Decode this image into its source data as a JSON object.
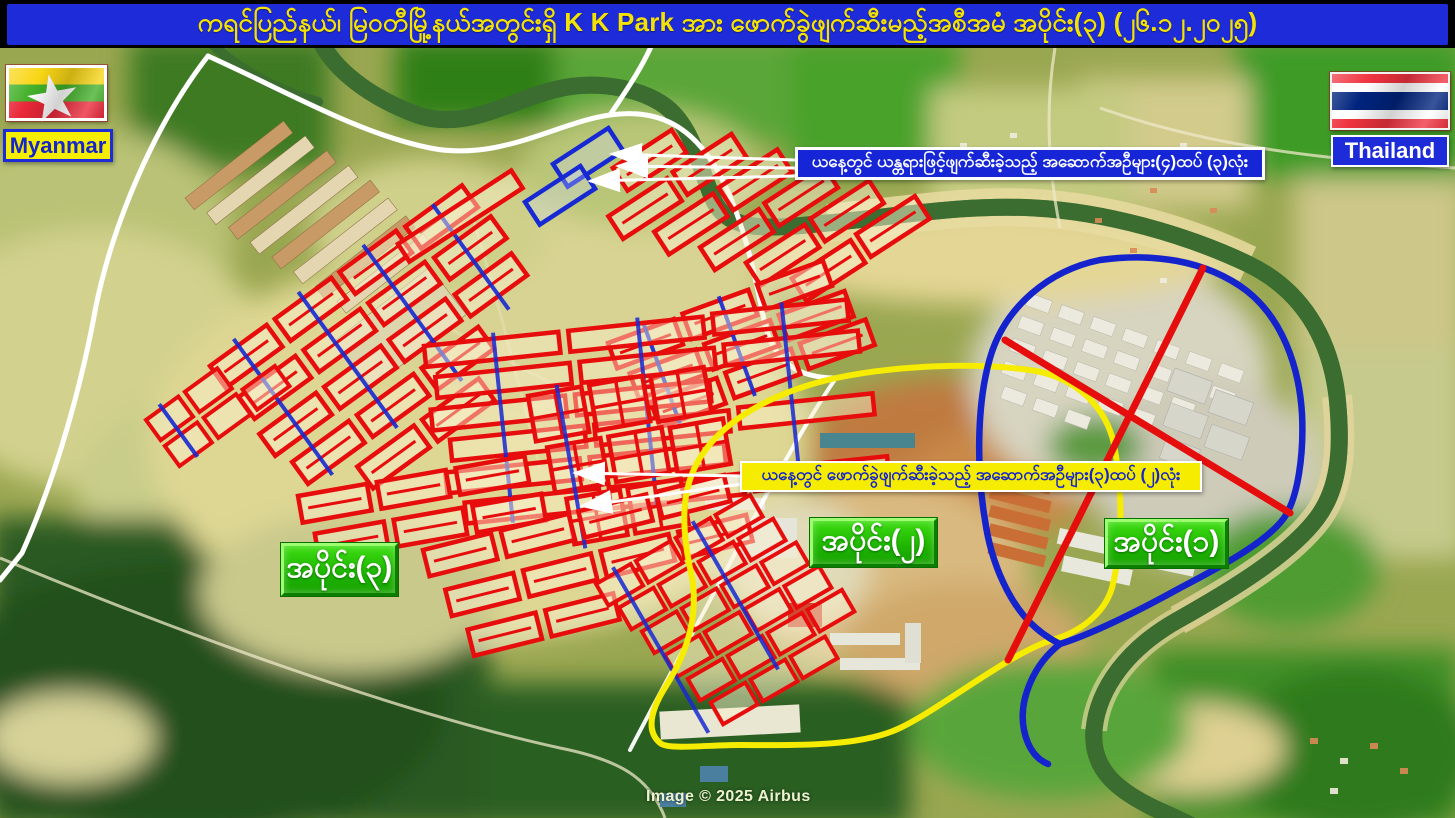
{
  "title_bar": {
    "text": "ကရင်ပြည်နယ်၊ မြဝတီမြို့နယ်အတွင်းရှိ  K K Park အား ဖောက်ခွဲဖျက်ဆီးမည့်အစီအမံ အပိုင်း(၃) (၂၆.၁၂.၂၀၂၅)",
    "bg_color": "#1e2bd8",
    "text_color": "#f4e300"
  },
  "flags": {
    "myanmar": {
      "label": "Myanmar",
      "stripe_colors": [
        "#f9d616",
        "#43b02a",
        "#ea2839"
      ],
      "star_color": "#ffffff",
      "label_bg": "#f6ee00",
      "label_text_color": "#1525cc"
    },
    "thailand": {
      "label": "Thailand",
      "stripe_colors": [
        "#ef3340",
        "#ffffff",
        "#00247d",
        "#ffffff",
        "#ef3340"
      ],
      "label_bg": "#1e2bd8",
      "label_text_color": "#ffffff"
    }
  },
  "callouts": {
    "machinery_destroyed": {
      "text": "ယနေ့တွင် ယန္တရားဖြင့်ဖျက်ဆီးခဲ့သည့် အဆောက်အဦများ(၄)ထပ် (၃)လုံး",
      "bg": "#1626d6",
      "text_color": "#ffffff",
      "border": "#ffffff"
    },
    "blast_destroyed": {
      "text": "ယနေ့တွင် ဖောက်ခွဲဖျက်ဆီးခဲ့သည့် အဆောက်အဦများ(၃)ထပ် (၂)လုံး",
      "bg": "#f6ec00",
      "text_color": "#1525cc",
      "border": "#ffffff"
    }
  },
  "region_labels": {
    "part1": "အပိုင်း(၁)",
    "part2": "အပိုင်း(၂)",
    "part3": "အပိုင်း(၃)",
    "label_bg": "#1db400",
    "label_text_color": "#ffffff"
  },
  "map": {
    "attribution": "Image © 2025 Airbus",
    "overlay_colors": {
      "destroyed_building_markers_red": "#e80d0d",
      "highlighted_buildings_blue": "#1729d2",
      "part1_boundary_blue": "#1423cc",
      "part2_boundary_yellow": "#f6ec00",
      "border_lines_white": "#ffffff",
      "crossed_out_x_red": "#e60d0d",
      "river_green": "#3b6d2f"
    }
  }
}
